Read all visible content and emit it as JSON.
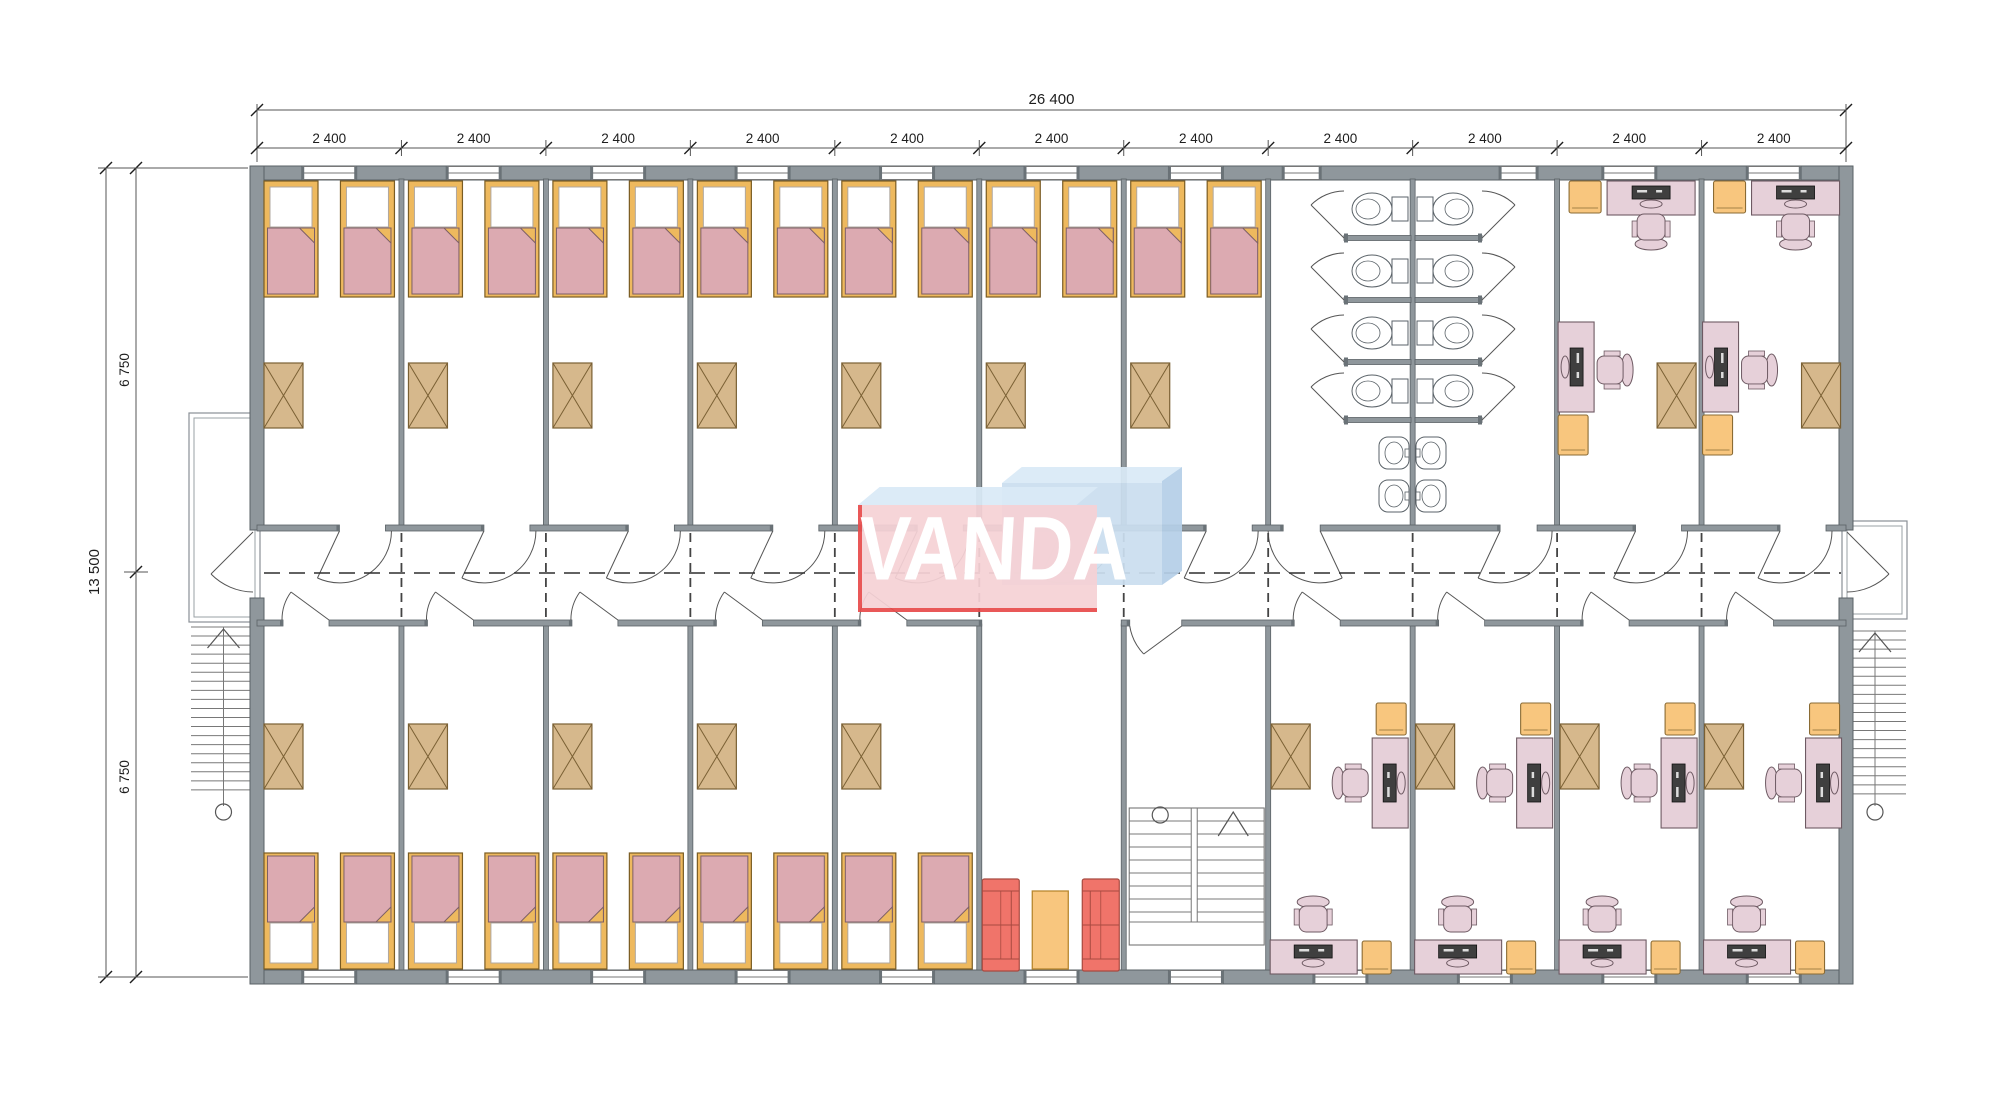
{
  "title": "dormitory-floor-plan",
  "dimensions": {
    "top_total": "26 400",
    "top_segments": [
      "2 400",
      "2 400",
      "2 400",
      "2 400",
      "2 400",
      "2 400",
      "2 400",
      "2 400",
      "2 400",
      "2 400",
      "2 400"
    ],
    "left_total": "13 500",
    "left_segments": [
      "6 750",
      "6 750"
    ]
  },
  "logo": {
    "text": "VANDA",
    "pink_slab": "#f6d2d6",
    "blue_slab": "#cadeef",
    "blue_light": "#d9e9f6",
    "blue_dark": "#b5cfe7",
    "red": "#e84c4c",
    "text_color": "#ffffff",
    "opacity": 0.93
  },
  "layout": {
    "bays": 11,
    "top_rooms": [
      "dorm",
      "dorm",
      "dorm",
      "dorm",
      "dorm",
      "dorm",
      "dorm",
      "bath_left",
      "bath_right",
      "office",
      "office"
    ],
    "bottom_rooms": [
      "dorm",
      "dorm",
      "dorm",
      "dorm",
      "dorm",
      "lounge",
      "stairwell",
      "office",
      "office",
      "office",
      "office"
    ],
    "toilet_stalls": 8,
    "sink_basins": 4,
    "beds_top": 14,
    "beds_bottom": 10
  },
  "colors": {
    "wall": "#8f979c",
    "wall_stroke": "#5a6166",
    "line": "#555555",
    "stair": "#787878",
    "dim": "#1d1d1d",
    "dash": "#2f2f2f",
    "bed_frame": "#eeb95e",
    "bed_frame_stroke": "#7a5c23",
    "mattress": "#dcaab1",
    "mattress_stroke": "#7d5f66",
    "pillow": "#ffffff",
    "wardrobe": "#d6b88c",
    "wardrobe_stroke": "#7a6034",
    "desk": "#e6d0d9",
    "desk_stroke": "#6e5a63",
    "device": "#3f3f3f",
    "cabinet": "#f8c67e",
    "cabinet_stroke": "#8a6b34",
    "sofa": "#f0746a",
    "sofa_stroke": "#a84a40",
    "table": "#f8c67e",
    "table_stroke": "#b8872f",
    "fixture": "#ffffff",
    "fixture_stroke": "#5a6268",
    "window": "#ffffff",
    "window_stroke": "#777777",
    "cap": "#6a7277"
  }
}
